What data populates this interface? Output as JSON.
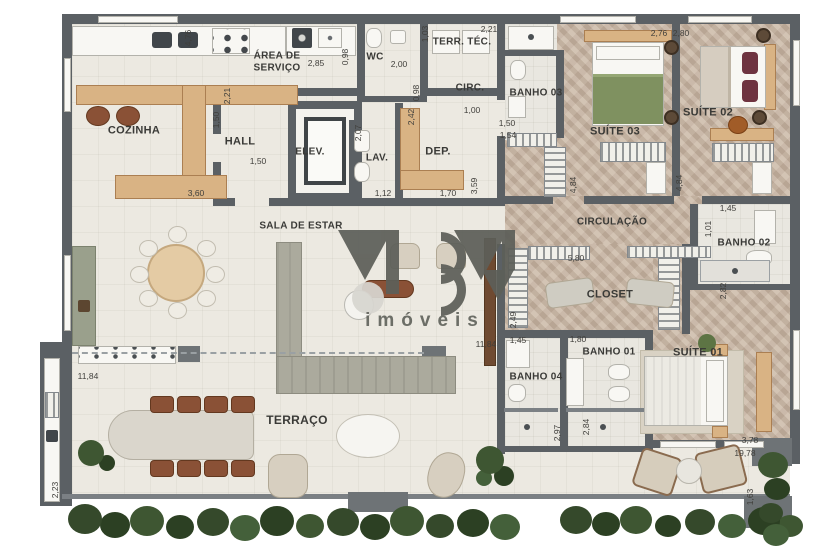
{
  "watermark": {
    "brand_text": "imóveis",
    "monogram": "MBM"
  },
  "palette": {
    "wall": "#5b6064",
    "floor": "#ece9e1",
    "wood_floor": "#c8b4a1",
    "counter_wood": "#d9b384",
    "sofa": "#abaa9d",
    "hedge": "#35492b",
    "label": "#3a3a37"
  },
  "rooms": [
    {
      "label": "COZINHA",
      "x": 134,
      "y": 131,
      "fs": 11
    },
    {
      "label": "ÁREA DE\nSERVIÇO",
      "x": 277,
      "y": 62,
      "fs": 10
    },
    {
      "label": "HALL",
      "x": 240,
      "y": 142,
      "fs": 11
    },
    {
      "label": "ELEV.",
      "x": 310,
      "y": 152,
      "fs": 10
    },
    {
      "label": "WC",
      "x": 375,
      "y": 57,
      "fs": 10
    },
    {
      "label": "TERR. TÉC.",
      "x": 462,
      "y": 42,
      "fs": 10
    },
    {
      "label": "CIRC.",
      "x": 470,
      "y": 88,
      "fs": 10
    },
    {
      "label": "LAV.",
      "x": 377,
      "y": 158,
      "fs": 10
    },
    {
      "label": "DEP.",
      "x": 438,
      "y": 152,
      "fs": 11
    },
    {
      "label": "BANHO 03",
      "x": 536,
      "y": 93,
      "fs": 10
    },
    {
      "label": "SUÍTE 03",
      "x": 615,
      "y": 132,
      "fs": 11
    },
    {
      "label": "SUÍTE 02",
      "x": 708,
      "y": 113,
      "fs": 11
    },
    {
      "label": "CIRCULAÇÃO",
      "x": 612,
      "y": 222,
      "fs": 10
    },
    {
      "label": "BANHO 02",
      "x": 744,
      "y": 243,
      "fs": 10
    },
    {
      "label": "CLOSET",
      "x": 610,
      "y": 295,
      "fs": 11
    },
    {
      "label": "BANHO 04",
      "x": 536,
      "y": 377,
      "fs": 10
    },
    {
      "label": "BANHO 01",
      "x": 609,
      "y": 352,
      "fs": 10
    },
    {
      "label": "SUÍTE 01",
      "x": 698,
      "y": 353,
      "fs": 11
    },
    {
      "label": "SALA DE ESTAR",
      "x": 301,
      "y": 226,
      "fs": 10
    },
    {
      "label": "TERRAÇO",
      "x": 297,
      "y": 421,
      "fs": 12
    }
  ],
  "dims": [
    {
      "v": "4,76",
      "x": 188,
      "y": 38,
      "rot": "v"
    },
    {
      "v": "2,85",
      "x": 316,
      "y": 63,
      "rot": "h"
    },
    {
      "v": "0,98",
      "x": 345,
      "y": 57,
      "rot": "v"
    },
    {
      "v": "2,00",
      "x": 399,
      "y": 64,
      "rot": "h"
    },
    {
      "v": "1,03",
      "x": 425,
      "y": 34,
      "rot": "v"
    },
    {
      "v": "2,21",
      "x": 489,
      "y": 29,
      "rot": "h"
    },
    {
      "v": "2,21",
      "x": 227,
      "y": 96,
      "rot": "v"
    },
    {
      "v": "1,50",
      "x": 216,
      "y": 120,
      "rot": "v"
    },
    {
      "v": "1,50",
      "x": 258,
      "y": 161,
      "rot": "h"
    },
    {
      "v": "3,60",
      "x": 196,
      "y": 193,
      "rot": "h"
    },
    {
      "v": "0,98",
      "x": 416,
      "y": 93,
      "rot": "v"
    },
    {
      "v": "1,00",
      "x": 472,
      "y": 110,
      "rot": "h"
    },
    {
      "v": "2,07",
      "x": 358,
      "y": 133,
      "rot": "v"
    },
    {
      "v": "1,12",
      "x": 383,
      "y": 193,
      "rot": "h"
    },
    {
      "v": "2,42",
      "x": 411,
      "y": 117,
      "rot": "v"
    },
    {
      "v": "1,70",
      "x": 448,
      "y": 193,
      "rot": "h"
    },
    {
      "v": "3,59",
      "x": 474,
      "y": 186,
      "rot": "v"
    },
    {
      "v": "1,50",
      "x": 507,
      "y": 123,
      "rot": "h"
    },
    {
      "v": "1,54",
      "x": 508,
      "y": 135,
      "rot": "h"
    },
    {
      "v": "2,76",
      "x": 659,
      "y": 33,
      "rot": "h"
    },
    {
      "v": "2,80",
      "x": 681,
      "y": 33,
      "rot": "h"
    },
    {
      "v": "4,84",
      "x": 573,
      "y": 185,
      "rot": "v"
    },
    {
      "v": "4,84",
      "x": 679,
      "y": 183,
      "rot": "v"
    },
    {
      "v": "1,45",
      "x": 728,
      "y": 208,
      "rot": "h"
    },
    {
      "v": "1,01",
      "x": 708,
      "y": 229,
      "rot": "v"
    },
    {
      "v": "2,82",
      "x": 723,
      "y": 291,
      "rot": "v"
    },
    {
      "v": "5,80",
      "x": 576,
      "y": 258,
      "rot": "h"
    },
    {
      "v": "2,49",
      "x": 513,
      "y": 320,
      "rot": "v"
    },
    {
      "v": "1,45",
      "x": 518,
      "y": 340,
      "rot": "h"
    },
    {
      "v": "1,80",
      "x": 578,
      "y": 339,
      "rot": "h"
    },
    {
      "v": "2,97",
      "x": 557,
      "y": 433,
      "rot": "v"
    },
    {
      "v": "2,84",
      "x": 586,
      "y": 427,
      "rot": "v"
    },
    {
      "v": "11,84",
      "x": 88,
      "y": 376,
      "rot": "h"
    },
    {
      "v": "11,84",
      "x": 486,
      "y": 344,
      "rot": "h"
    },
    {
      "v": "2,23",
      "x": 55,
      "y": 490,
      "rot": "v"
    },
    {
      "v": "3,78",
      "x": 750,
      "y": 440,
      "rot": "h"
    },
    {
      "v": "19,78",
      "x": 745,
      "y": 453,
      "rot": "h"
    },
    {
      "v": "1,63",
      "x": 750,
      "y": 497,
      "rot": "v"
    }
  ]
}
